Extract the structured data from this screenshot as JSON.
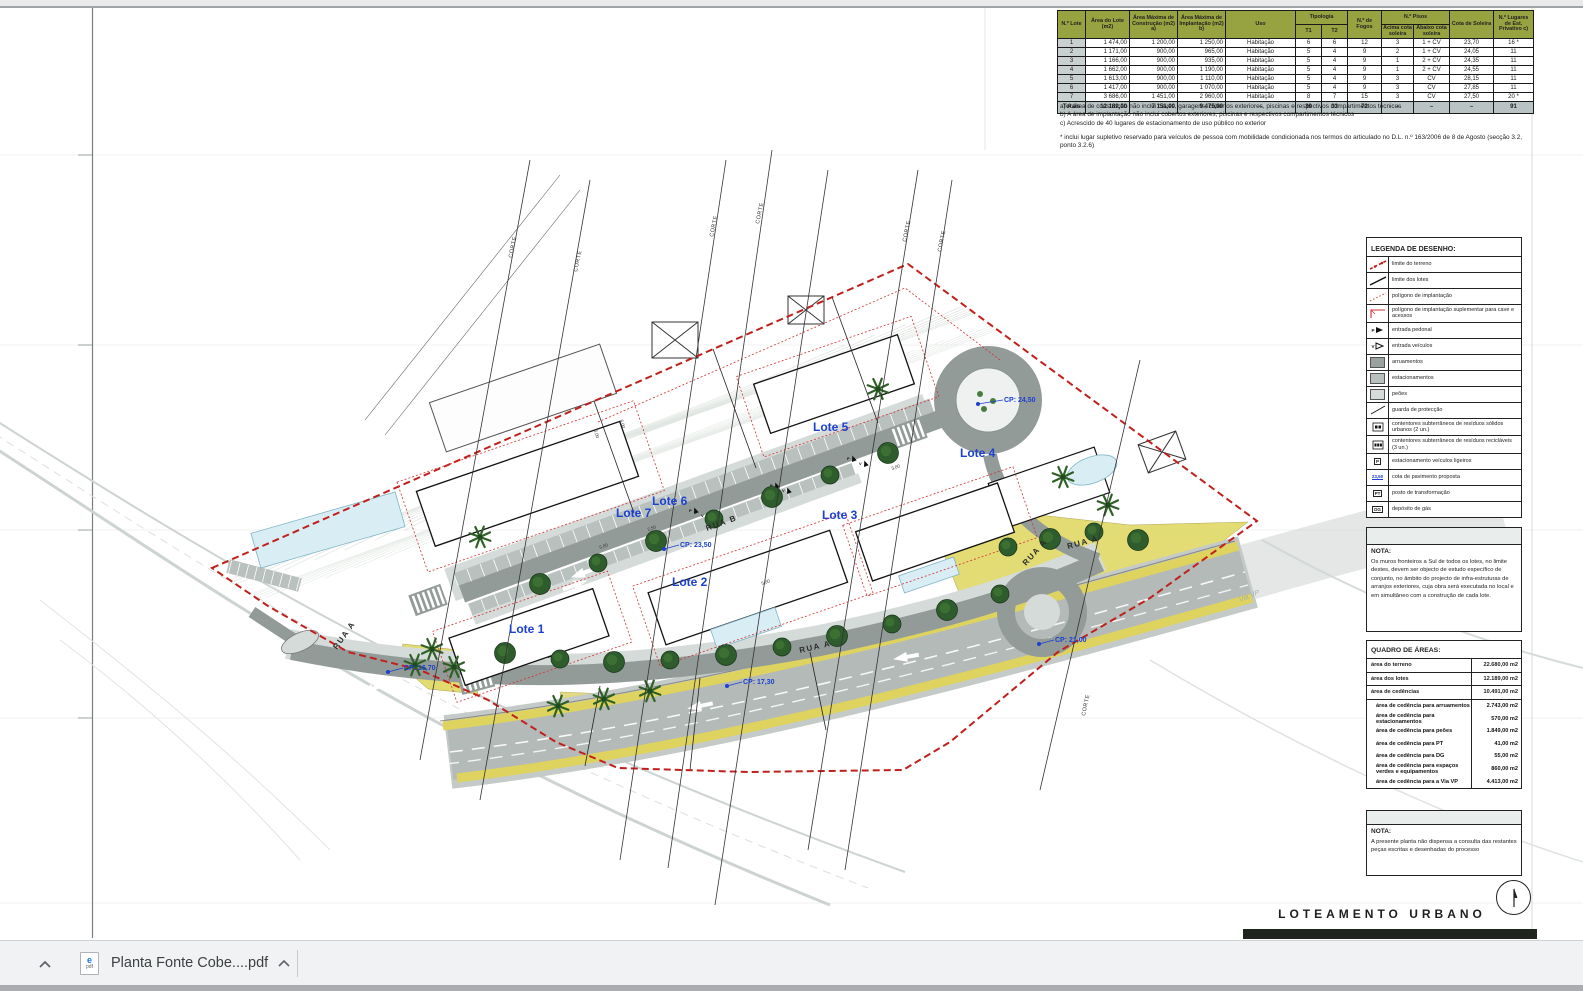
{
  "colors": {
    "accent_blue": "#1c40cf",
    "boundary_red": "#c0201c",
    "road_dark": "#939b99",
    "parking_mid": "#b9c1bf",
    "pedestrian_light": "#d4dbd9",
    "landscape_yellow": "#e2db6e",
    "tree_green": "#2e5c2c",
    "table_header_green": "#97a341"
  },
  "lot_table": {
    "header": {
      "lote": "N.º Lote",
      "area_lote": "Área do Lote (m2)",
      "area_construcao": "Área Máxima de Construção (m2) a)",
      "area_implantacao": "Área Máxima de Implantação (m2) b)",
      "uso": "Uso",
      "tipologia": "Tipologia",
      "t1": "T1",
      "t2": "T2",
      "fogos": "N.º de Fogos",
      "pisos": "N.º Pisos",
      "acima": "Acima cota soleira",
      "abaixo": "Abaixo cota soleira",
      "cota": "Cota de Soleira",
      "lugares": "N.º Lugares de Est. Privativo c)"
    },
    "rows": [
      [
        "1",
        "1 474,00",
        "1 200,00",
        "1 250,00",
        "Habitação",
        "6",
        "6",
        "12",
        "3",
        "1 + CV",
        "23,70",
        "16 *"
      ],
      [
        "2",
        "1 171,00",
        "900,00",
        "965,00",
        "Habitação",
        "5",
        "4",
        "9",
        "2",
        "1 + CV",
        "24,05",
        "11"
      ],
      [
        "3",
        "1 166,00",
        "900,00",
        "935,00",
        "Habitação",
        "5",
        "4",
        "9",
        "1",
        "2 + CV",
        "24,35",
        "11"
      ],
      [
        "4",
        "1 662,00",
        "900,00",
        "1 190,00",
        "Habitação",
        "5",
        "4",
        "9",
        "1",
        "2 + CV",
        "24,55",
        "11"
      ],
      [
        "5",
        "1 613,00",
        "900,00",
        "1 110,00",
        "Habitação",
        "5",
        "4",
        "9",
        "3",
        "CV",
        "28,15",
        "11"
      ],
      [
        "6",
        "1 417,00",
        "900,00",
        "1 070,00",
        "Habitação",
        "5",
        "4",
        "9",
        "3",
        "CV",
        "27,85",
        "11"
      ],
      [
        "7",
        "3 686,00",
        "1 451,00",
        "2 960,00",
        "Habitação",
        "8",
        "7",
        "15",
        "3",
        "CV",
        "27,50",
        "20 *"
      ]
    ],
    "totals": [
      "Totais",
      "12 189,00",
      "7 151,00",
      "9 475,00",
      "–",
      "39",
      "33",
      "72",
      "–",
      "–",
      "–",
      "91"
    ],
    "footnotes": [
      "a) A área de construção não inclui caves, garagens, cobertos exteriores, piscinas e respectivos compartimentos técnicos",
      "b) A área de implantação não inclui cobertos exteriores, piscinas e respectivos compartimentos técnicos",
      "c) Acrescido de 40 lugares de estacionamento de uso público no exterior"
    ],
    "footnote_star": "* inclui lugar supletivo reservado para veículos de pessoa com mobilidade condicionada nos termos do articulado no D.L. n.º 163/2006 de 8 de Agosto (secção 3.2, ponto 3.2.6)"
  },
  "legend": {
    "title": "LEGENDA DE DESENHO:",
    "items": [
      {
        "icon": "limite-terreno",
        "label": "limite do terreno"
      },
      {
        "icon": "limite-lotes",
        "label": "limite dos lotes"
      },
      {
        "icon": "pol-impl",
        "label": "polígono de implantação"
      },
      {
        "icon": "pol-impl-sup",
        "label": "polígono de implantação suplementar para cave e acessos"
      },
      {
        "icon": "entrada-pedonal",
        "label": "entrada pedonal",
        "glyph": "P"
      },
      {
        "icon": "entrada-veiculos",
        "label": "entrada veículos",
        "glyph": "V"
      },
      {
        "icon": "sw-dark",
        "label": "arruamentos"
      },
      {
        "icon": "sw-mid",
        "label": "estacionamentos"
      },
      {
        "icon": "sw-light",
        "label": "peões"
      },
      {
        "icon": "guarda",
        "label": "guarda de protecção"
      },
      {
        "icon": "cont-2",
        "label": "contentores subterrâneos de resíduos sólidos urbanos (2 un.)"
      },
      {
        "icon": "cont-3",
        "label": "contentores subterrâneos de resíduos recicláveis (3 un.)"
      },
      {
        "icon": "est-ligeiros",
        "label": "estacionamento veículos ligeiros",
        "glyph": "P"
      },
      {
        "icon": "cota-pav",
        "label": "cota de pavimento proposta",
        "glyph": "23,50"
      },
      {
        "icon": "pt",
        "label": "posto de transformação",
        "glyph": "PT"
      },
      {
        "icon": "dg",
        "label": "depósito de gás",
        "glyph": "DG"
      }
    ]
  },
  "nota1": {
    "title": "NOTA:",
    "text": "Os muros fronteiros a Sul de todos os lotes, no limite destes, devem ser objecto de estudo específico de conjunto, no âmbito do projecto de infra-estruturas de arranjos exteriores, cuja obra será executada no local e em simultâneo com a construção de cada lote."
  },
  "quadro_areas": {
    "title": "QUADRO DE ÁREAS:",
    "rows": [
      {
        "label": "área do terreno",
        "value": "22.680,00 m2",
        "level": 0
      },
      {
        "label": "área dos lotes",
        "value": "12.189,00 m2",
        "level": 0
      },
      {
        "label": "área de cedências",
        "value": "10.491,00 m2",
        "level": 0
      },
      {
        "label": "área de cedência para arruamentos",
        "value": "2.743,00 m2",
        "level": 1
      },
      {
        "label": "área de cedência para estacionamentos",
        "value": "570,00 m2",
        "level": 1
      },
      {
        "label": "área de cedência para peões",
        "value": "1.849,00 m2",
        "level": 1
      },
      {
        "label": "área de cedência para PT",
        "value": "41,00 m2",
        "level": 1
      },
      {
        "label": "área de cedência para DG",
        "value": "55,00 m2",
        "level": 1
      },
      {
        "label": "área de cedência para espaços verdes e equipamentos",
        "value": "860,00 m2",
        "level": 1
      },
      {
        "label": "área de cedência para a Via VP",
        "value": "4.413,00 m2",
        "level": 1
      }
    ]
  },
  "nota2": {
    "title": "NOTA:",
    "text": "A presente planta não dispensa a consulta das restantes peças escritas e desenhadas do processo"
  },
  "sheet": {
    "title": "LOTEAMENTO URBANO"
  },
  "plan": {
    "lot_labels": [
      {
        "text": "Lote 1",
        "x": 509,
        "y": 633
      },
      {
        "text": "Lote 2",
        "x": 672,
        "y": 586
      },
      {
        "text": "Lote 3",
        "x": 822,
        "y": 519
      },
      {
        "text": "Lote 4",
        "x": 960,
        "y": 457
      },
      {
        "text": "Lote 5",
        "x": 813,
        "y": 431
      },
      {
        "text": "Lote 6",
        "x": 652,
        "y": 505
      },
      {
        "text": "Lote 7",
        "x": 616,
        "y": 517
      }
    ],
    "street_labels": [
      {
        "text": "RUA B",
        "x": 707,
        "y": 531,
        "rot": -20
      },
      {
        "text": "RUA A",
        "x": 800,
        "y": 653,
        "rot": -13
      },
      {
        "text": "RUA A",
        "x": 1068,
        "y": 549,
        "rot": -15
      },
      {
        "text": "RUA A",
        "x": 1026,
        "y": 566,
        "rot": -48
      },
      {
        "text": "RUA A",
        "x": 337,
        "y": 650,
        "rot": -55
      }
    ],
    "cp_labels": [
      {
        "text": "CP: 24,50",
        "x": 1004,
        "y": 402,
        "dx": 978,
        "dy": 404
      },
      {
        "text": "CP: 23,50",
        "x": 680,
        "y": 547,
        "dx": 664,
        "dy": 549
      },
      {
        "text": "CP: 16,70",
        "x": 404,
        "y": 670,
        "dx": 388,
        "dy": 672
      },
      {
        "text": "CP: 17,30",
        "x": 743,
        "y": 684,
        "dx": 727,
        "dy": 686
      },
      {
        "text": "CP: 21,00",
        "x": 1055,
        "y": 642,
        "dx": 1039,
        "dy": 644
      }
    ],
    "corte_label": "CORTE",
    "corte_positions": [
      {
        "x": 512,
        "y": 258
      },
      {
        "x": 577,
        "y": 272
      },
      {
        "x": 713,
        "y": 237
      },
      {
        "x": 759,
        "y": 224
      },
      {
        "x": 906,
        "y": 242
      },
      {
        "x": 941,
        "y": 252
      },
      {
        "x": 1085,
        "y": 716
      }
    ],
    "via_label": {
      "text": "Via VP",
      "x": 1240,
      "y": 602,
      "rot": -22
    },
    "dim_labels": [
      {
        "text": "6,00",
        "x": 594,
        "y": 430,
        "rot": 75
      },
      {
        "text": "6,00",
        "x": 620,
        "y": 420,
        "rot": 75
      },
      {
        "text": "5,00",
        "x": 600,
        "y": 549,
        "rot": -20
      },
      {
        "text": "2,50",
        "x": 648,
        "y": 531,
        "rot": -20
      },
      {
        "text": "3,00",
        "x": 892,
        "y": 470,
        "rot": -20
      },
      {
        "text": "5,00",
        "x": 762,
        "y": 585,
        "rot": -20
      }
    ],
    "entrance_p": "P",
    "entrance_v": "V"
  },
  "bottom_bar": {
    "file_name": "Planta Fonte Cobe....pdf"
  }
}
